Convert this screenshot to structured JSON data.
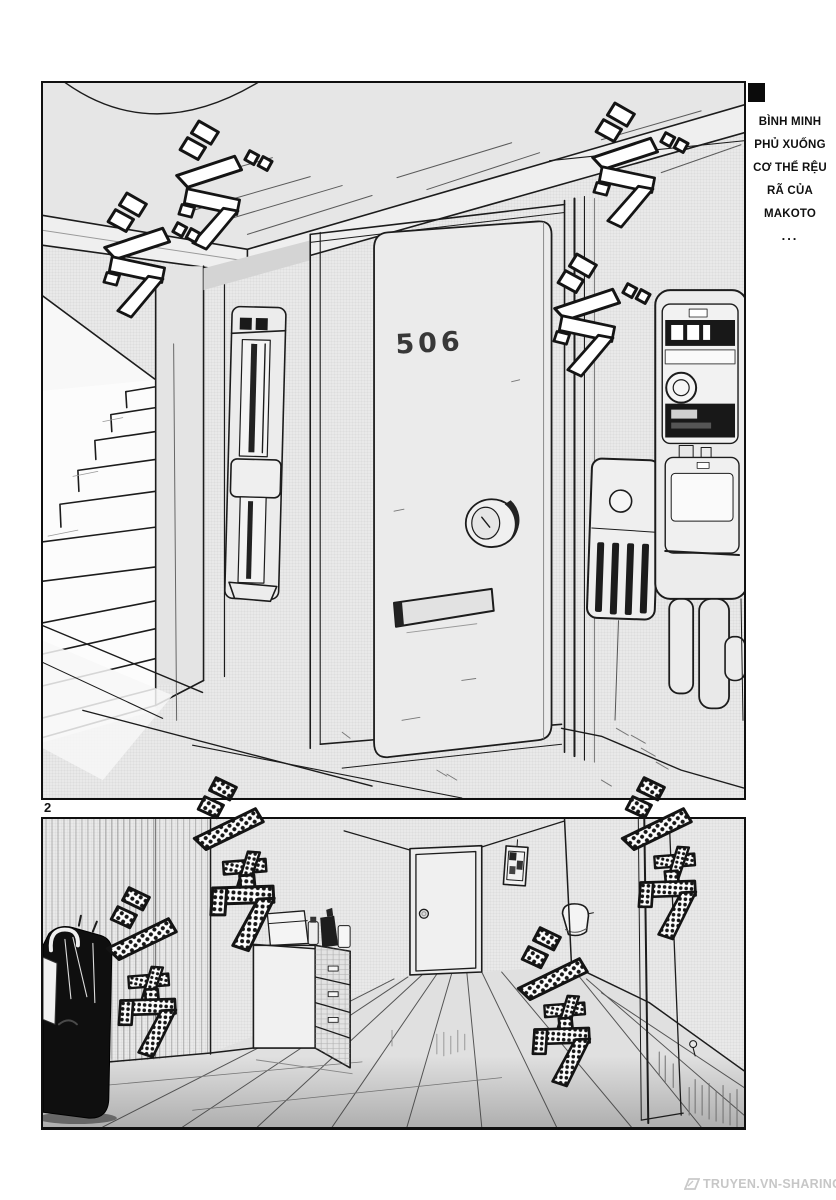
{
  "page": {
    "number": "2"
  },
  "caption": {
    "lines": [
      "BÌNH MINH",
      "PHỦ XUỐNG",
      "CƠ THỂ RỆU",
      "RÃ CỦA",
      "MAKOTO",
      "..."
    ]
  },
  "panel1": {
    "door_number": "506"
  },
  "sfx": {
    "jiwa_reading": "ジワ",
    "shau_reading": "シャウ",
    "jiwa": [
      "ジ",
      "ワ"
    ],
    "shau": [
      "シ",
      "ャ",
      "ウ"
    ]
  },
  "watermark": {
    "text": "TRUYEN.VN-SHARING.NET"
  },
  "colors": {
    "ink": "#1c1c1c",
    "screentone": "#e9e9e9",
    "paper": "#ffffff",
    "watermark_gray": "#c7c7c7",
    "sfx_fill_panel1": "#ffffff",
    "sfx_fill_panel2": "halftone-dots"
  }
}
